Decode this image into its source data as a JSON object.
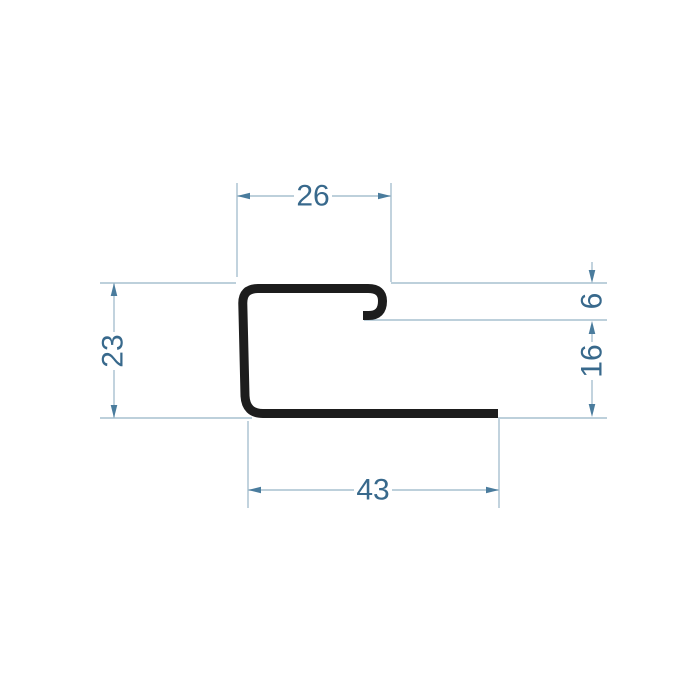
{
  "diagram": {
    "kind": "profile-cross-section-drawing",
    "dimensions": {
      "top_width": {
        "value": "26"
      },
      "left_height": {
        "value": "23"
      },
      "lip_height": {
        "value": "6"
      },
      "right_height": {
        "value": "16"
      },
      "bottom_width": {
        "value": "43"
      }
    },
    "colors": {
      "background": "#ffffff",
      "profile": "#1d1d1d",
      "dimension_line": "#a7c0cf",
      "arrow": "#4a7c9d",
      "text": "#38698c"
    }
  }
}
